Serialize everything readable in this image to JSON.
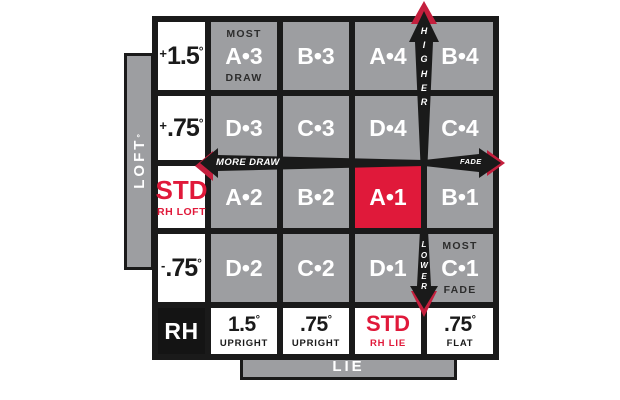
{
  "palette": {
    "cell_gray": "#9d9ea1",
    "bar_gray": "#9d9ea1",
    "grid_black": "#1a1a1a",
    "highlight_red": "#e0193a",
    "arrow_tip_red": "#c41f3d",
    "white": "#ffffff",
    "annotation_dark": "#2d2d2d"
  },
  "axes": {
    "loft": {
      "label": "LOFT",
      "degree": "°"
    },
    "lie": {
      "label": "LIE"
    }
  },
  "arrows": {
    "higher": {
      "label": "HIGHER",
      "direction": "up"
    },
    "lower": {
      "label": "LOWER",
      "direction": "down"
    },
    "more_draw": {
      "label": "MORE DRAW",
      "direction": "left"
    },
    "fade": {
      "label": "FADE",
      "direction": "right"
    }
  },
  "grid": {
    "rows": [
      {
        "cells": [
          {
            "kind": "loft",
            "sign": "+",
            "value": "1.5",
            "degree": "°"
          },
          {
            "kind": "code",
            "top": "MOST",
            "code": "A•3",
            "bottom": "DRAW"
          },
          {
            "kind": "code",
            "code": "B•3"
          },
          {
            "kind": "code",
            "code": "A•4"
          },
          {
            "kind": "code",
            "code": "B•4"
          }
        ]
      },
      {
        "cells": [
          {
            "kind": "loft",
            "sign": "+",
            "value": ".75",
            "degree": "°"
          },
          {
            "kind": "code",
            "code": "D•3"
          },
          {
            "kind": "code",
            "code": "C•3"
          },
          {
            "kind": "code",
            "code": "D•4"
          },
          {
            "kind": "code",
            "code": "C•4"
          }
        ]
      },
      {
        "cells": [
          {
            "kind": "loft-std",
            "value": "STD",
            "sub": "RH LOFT"
          },
          {
            "kind": "code",
            "code": "A•2"
          },
          {
            "kind": "code",
            "code": "B•2"
          },
          {
            "kind": "code",
            "code": "A•1",
            "highlight": true
          },
          {
            "kind": "code",
            "code": "B•1"
          }
        ]
      },
      {
        "cells": [
          {
            "kind": "loft",
            "sign": "-",
            "value": ".75",
            "degree": "°"
          },
          {
            "kind": "code",
            "code": "D•2"
          },
          {
            "kind": "code",
            "code": "C•2"
          },
          {
            "kind": "code",
            "code": "D•1"
          },
          {
            "kind": "code",
            "top": "MOST",
            "code": "C•1",
            "bottom": "FADE"
          }
        ]
      },
      {
        "cells": [
          {
            "kind": "hand",
            "value": "RH"
          },
          {
            "kind": "lie",
            "value": "1.5",
            "degree": "°",
            "sub": "UPRIGHT"
          },
          {
            "kind": "lie",
            "value": ".75",
            "degree": "°",
            "sub": "UPRIGHT"
          },
          {
            "kind": "lie-std",
            "value": "STD",
            "sub": "RH LIE"
          },
          {
            "kind": "lie",
            "value": ".75",
            "degree": "°",
            "sub": "FLAT"
          }
        ]
      }
    ]
  }
}
